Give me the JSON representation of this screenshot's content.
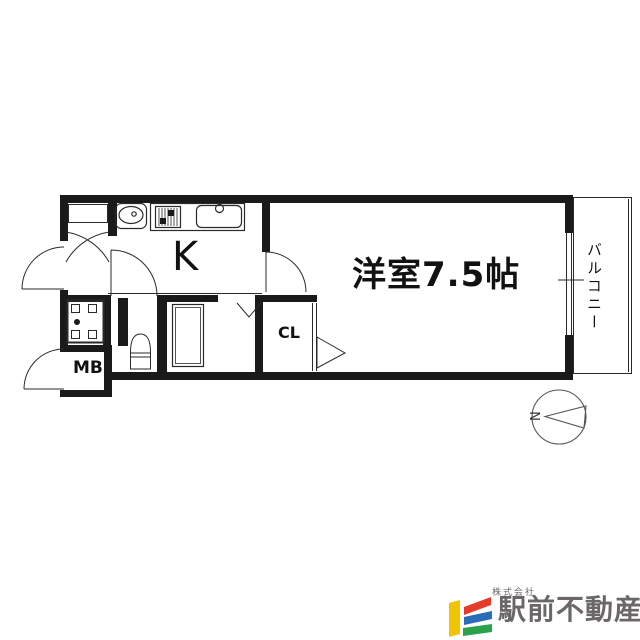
{
  "floorplan": {
    "labels": {
      "kitchen": "K",
      "main_room": "洋室7.5帖",
      "balcony": "バルコニー",
      "closet": "CL",
      "meter_box": "MB"
    },
    "compass": {
      "north": "N"
    },
    "line_color": "#1a1a1a"
  },
  "logo": {
    "company_prefix": "株式会社",
    "company_name": "駅前不動産",
    "colors": {
      "yellow": "#f0c400",
      "red": "#e63b28",
      "blue": "#2a6cb8",
      "green": "#2aa24d",
      "text": "#6b6767"
    }
  }
}
